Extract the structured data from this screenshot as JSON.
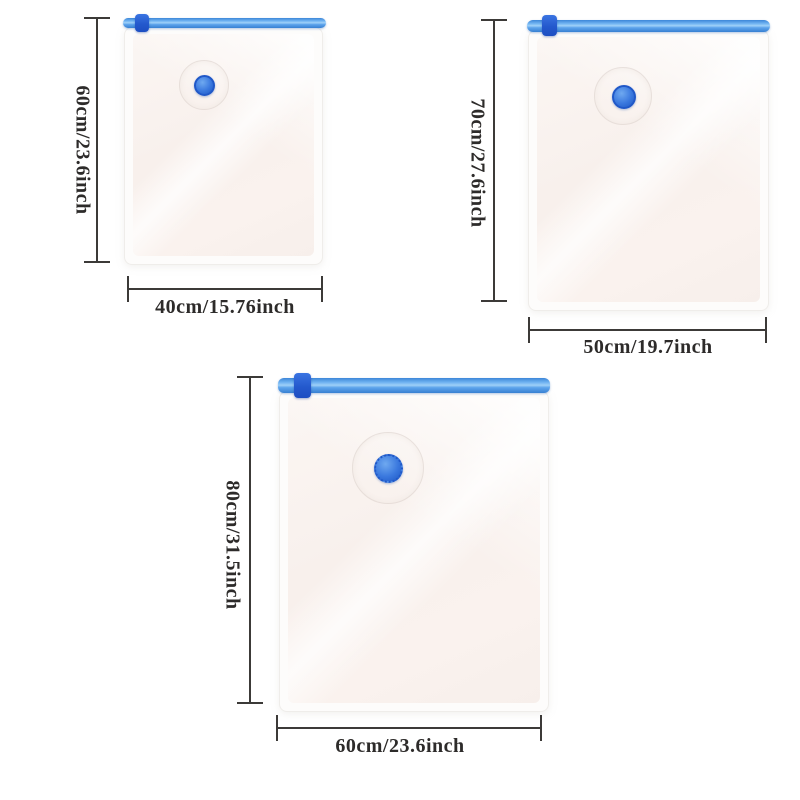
{
  "canvas": {
    "background": "#ffffff"
  },
  "style": {
    "zipper_blue": "#4a94e2",
    "slider_blue": "#2459cd",
    "valve_blue": "#2e6fd8",
    "bag_film_tint": "#f8f0ec",
    "dimension_line_color": "#3c3a38",
    "label_text_color": "#2d2b2a"
  },
  "bags": [
    {
      "name": "small-bag",
      "height_label": "60cm/23.6inch",
      "width_label": "40cm/15.76inch"
    },
    {
      "name": "medium-bag",
      "height_label": "70cm/27.6inch",
      "width_label": "50cm/19.7inch"
    },
    {
      "name": "large-bag",
      "height_label": "80cm/31.5inch",
      "width_label": "60cm/23.6inch"
    }
  ]
}
